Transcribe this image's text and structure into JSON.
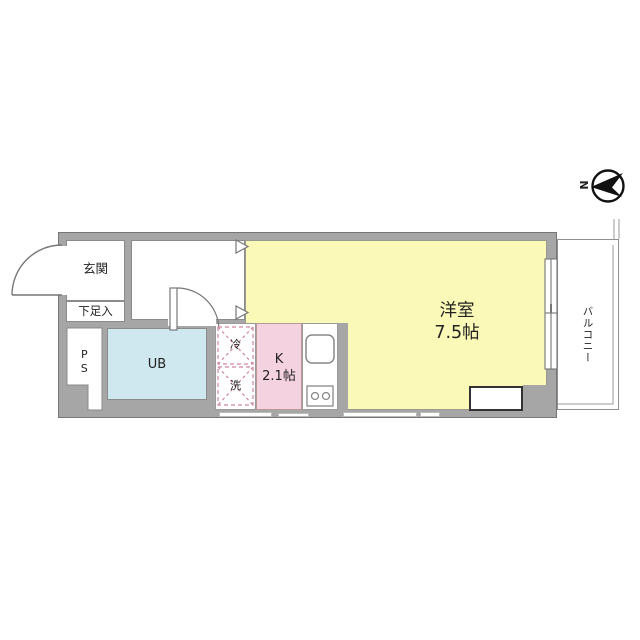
{
  "plan": {
    "type": "floorplan",
    "compass": {
      "north_label": "N"
    },
    "rooms": {
      "entrance": {
        "label": "玄関"
      },
      "shoe_box": {
        "label": "下足入"
      },
      "pipe_space": {
        "label": "PS"
      },
      "unit_bath": {
        "label": "UB"
      },
      "refrigerator": {
        "label": "冷"
      },
      "washer": {
        "label": "洗"
      },
      "kitchen": {
        "label": "K",
        "size": "2.1帖"
      },
      "western_room": {
        "label": "洋室",
        "size": "7.5帖"
      },
      "balcony": {
        "label": "バルコニー"
      }
    },
    "colors": {
      "wall_gray": "#a6a6a6",
      "room_yellow": "#faf9b7",
      "kitchen_pink": "#f5d2e0",
      "bath_blue": "#cfe7ef",
      "appliance_dash_pink": "#cf86a0",
      "line_gray": "#777777"
    }
  }
}
